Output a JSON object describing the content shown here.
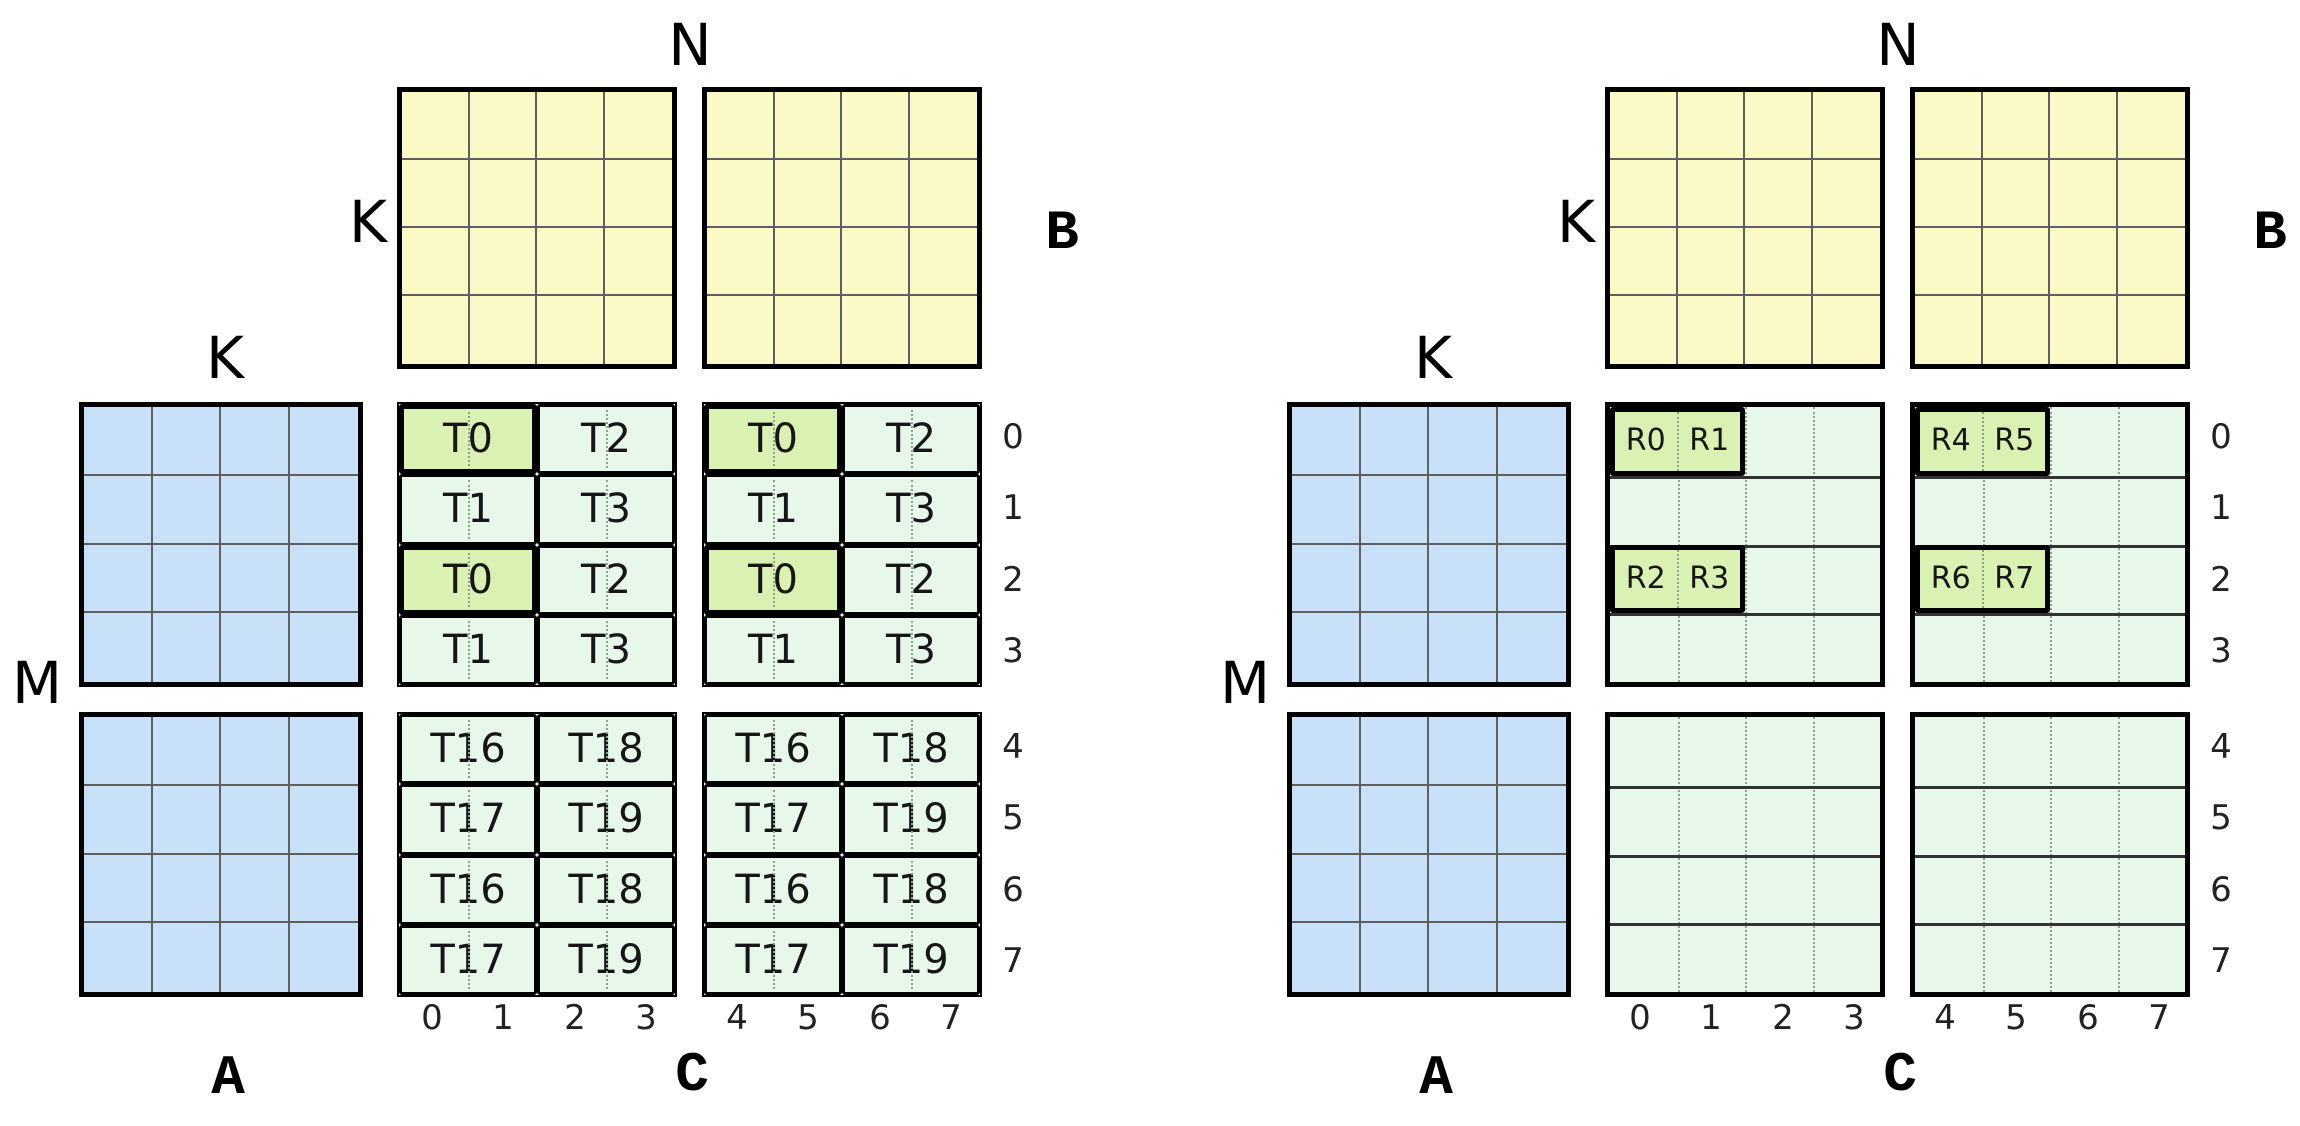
{
  "colors": {
    "matrix_a_fill": "#C8E1F8",
    "matrix_b_fill": "#FBF9C6",
    "matrix_c_fill": "#E7F7E9",
    "highlight_fill": "#D9F1B2",
    "border": "#000000",
    "grid_line": "#5F5F5F",
    "dotted_line": "#8FA08F",
    "row_line": "#333333",
    "text": "#161616"
  },
  "labels": {
    "dim_n": "N",
    "dim_k": "K",
    "dim_m": "M",
    "matrix_a": "A",
    "matrix_b": "B",
    "matrix_c": "C"
  },
  "row_indices": [
    "0",
    "1",
    "2",
    "3",
    "4",
    "5",
    "6",
    "7"
  ],
  "col_indices": [
    "0",
    "1",
    "2",
    "3",
    "4",
    "5",
    "6",
    "7"
  ],
  "left": {
    "c_blocks": {
      "top_left": {
        "rows": [
          [
            "T0",
            "T2"
          ],
          [
            "T1",
            "T3"
          ],
          [
            "T0",
            "T2"
          ],
          [
            "T1",
            "T3"
          ]
        ],
        "highlighted_cells": [
          [
            0,
            0
          ],
          [
            2,
            0
          ]
        ]
      },
      "top_right": {
        "rows": [
          [
            "T0",
            "T2"
          ],
          [
            "T1",
            "T3"
          ],
          [
            "T0",
            "T2"
          ],
          [
            "T1",
            "T3"
          ]
        ],
        "highlighted_cells": [
          [
            0,
            0
          ],
          [
            2,
            0
          ]
        ]
      },
      "bottom_left": {
        "rows": [
          [
            "T16",
            "T18"
          ],
          [
            "T17",
            "T19"
          ],
          [
            "T16",
            "T18"
          ],
          [
            "T17",
            "T19"
          ]
        ],
        "highlighted_cells": []
      },
      "bottom_right": {
        "rows": [
          [
            "T16",
            "T18"
          ],
          [
            "T17",
            "T19"
          ],
          [
            "T16",
            "T18"
          ],
          [
            "T17",
            "T19"
          ]
        ],
        "highlighted_cells": []
      }
    }
  },
  "right": {
    "r_groups": [
      {
        "block": "top_left",
        "row": 0,
        "labels": [
          "R0",
          "R1"
        ]
      },
      {
        "block": "top_left",
        "row": 2,
        "labels": [
          "R2",
          "R3"
        ]
      },
      {
        "block": "top_right",
        "row": 0,
        "labels": [
          "R4",
          "R5"
        ]
      },
      {
        "block": "top_right",
        "row": 2,
        "labels": [
          "R6",
          "R7"
        ]
      }
    ]
  }
}
